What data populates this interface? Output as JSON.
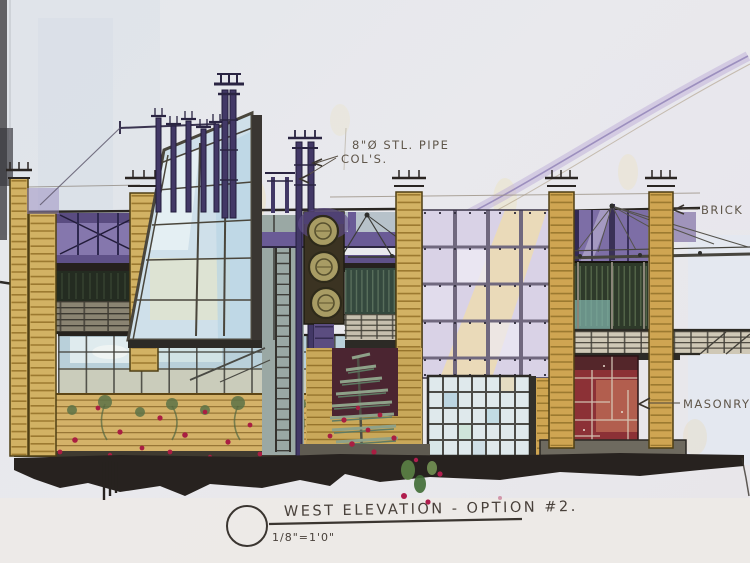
{
  "sheet": {
    "description": "Hand-drawn watercolor architectural elevation sketch, photographed",
    "paper_color": "#e8e9ed"
  },
  "annotations": {
    "pipe_cols_line1": "8\"Ø STL. PIPE",
    "pipe_cols_line2": "COL'S.",
    "brick": "BRICK",
    "masonry": "MASONRY"
  },
  "title_block": {
    "title": "WEST ELEVATION - OPTION #2.",
    "scale": "1/8\"=1'0\""
  },
  "palette": {
    "ink": "#2a2522",
    "ground_band": "#27221f",
    "brick_tan": "#d2b264",
    "brick_stripe": "#9c7a30",
    "glazing_purple": "#8577ad",
    "beam_purple": "#5f5188",
    "curtainwall_lavender": "#d9d2e6",
    "highlight_yellow": "#f0e0a8",
    "storefront_blue": "#b9d0da",
    "masonry_red": "#8c3136",
    "dark_green_band": "#2e3a2a",
    "medallion_olive": "#a89c64",
    "flower_red": "#a91e42",
    "pipe_purple": "#423866"
  }
}
